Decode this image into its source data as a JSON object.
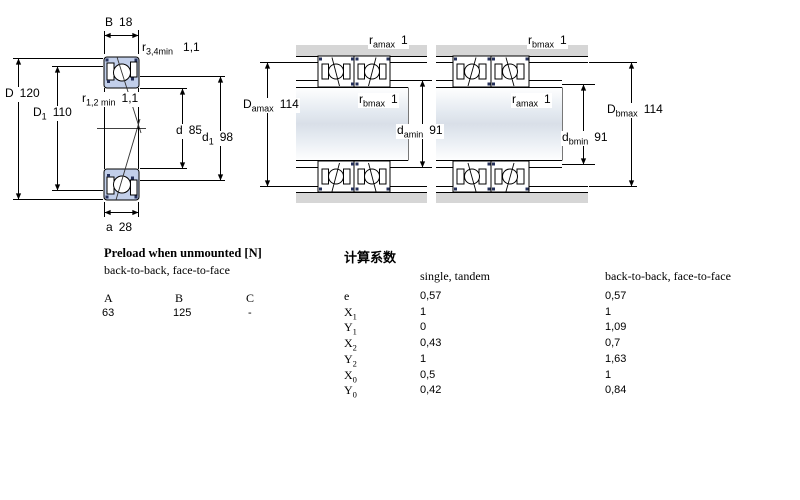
{
  "dims": {
    "B": {
      "sym": "B",
      "sub": "",
      "val": "18"
    },
    "r34": {
      "sym": "r",
      "sub": "3,4min",
      "val": "1,1"
    },
    "D": {
      "sym": "D",
      "sub": "",
      "val": "120"
    },
    "D1": {
      "sym": "D",
      "sub": "1",
      "val": "110"
    },
    "r12": {
      "sym": "r",
      "sub": "1,2 min",
      "val": "1,1"
    },
    "d": {
      "sym": "d",
      "sub": "",
      "val": "85"
    },
    "d1": {
      "sym": "d",
      "sub": "1",
      "val": "98"
    },
    "a": {
      "sym": "a",
      "sub": "",
      "val": "28"
    },
    "ramax_top": {
      "sym": "r",
      "sub": "amax",
      "val": "1"
    },
    "Damax": {
      "sym": "D",
      "sub": "amax",
      "val": "114"
    },
    "rbmax_mid": {
      "sym": "r",
      "sub": "bmax",
      "val": "1"
    },
    "damin": {
      "sym": "d",
      "sub": "amin",
      "val": "91"
    },
    "rbmax_top": {
      "sym": "r",
      "sub": "bmax",
      "val": "1"
    },
    "ramax_mid": {
      "sym": "r",
      "sub": "amax",
      "val": "1"
    },
    "dbmin": {
      "sym": "d",
      "sub": "bmin",
      "val": "91"
    },
    "Dbmax": {
      "sym": "D",
      "sub": "bmax",
      "val": "114"
    }
  },
  "preload": {
    "title": "Preload when unmounted [N]",
    "subtitle": "back-to-back, face-to-face",
    "columns": [
      "A",
      "B",
      "C"
    ],
    "values": [
      "63",
      "125",
      "-"
    ]
  },
  "factors": {
    "title": "计算系数",
    "col1": "single, tandem",
    "col2": "back-to-back, face-to-face",
    "rows": [
      {
        "sym": "e",
        "sub": "",
        "single": "0,57",
        "btb": "0,57"
      },
      {
        "sym": "X",
        "sub": "1",
        "single": "1",
        "btb": "1"
      },
      {
        "sym": "Y",
        "sub": "1",
        "single": "0",
        "btb": "1,09"
      },
      {
        "sym": "X",
        "sub": "2",
        "single": "0,43",
        "btb": "0,7"
      },
      {
        "sym": "Y",
        "sub": "2",
        "single": "1",
        "btb": "1,63"
      },
      {
        "sym": "X",
        "sub": "0",
        "single": "0,5",
        "btb": "1"
      },
      {
        "sym": "Y",
        "sub": "0",
        "single": "0,42",
        "btb": "0,84"
      }
    ]
  },
  "colors": {
    "bearing_fill": "#c2cfea",
    "dark_accent": "#25305a",
    "housing_gray": "#d6d6d6",
    "shaft_mid": "#d9dfe8"
  }
}
